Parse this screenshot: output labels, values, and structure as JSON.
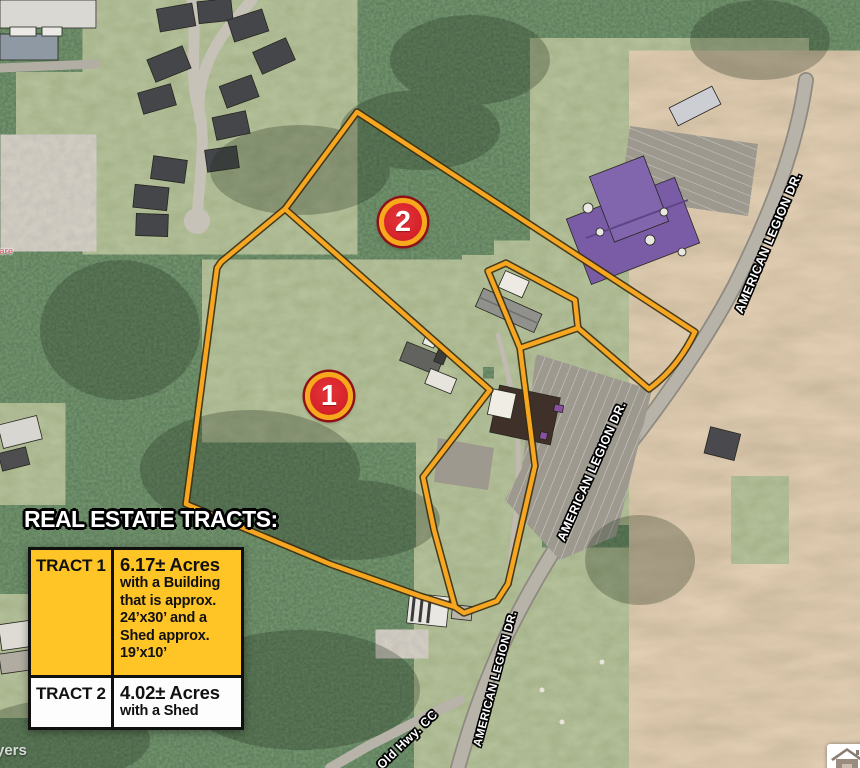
{
  "tracts_panel": {
    "header": "REAL ESTATE TRACTS:",
    "rows": [
      {
        "name": "TRACT 1",
        "desc": [
          "6.17± Acres",
          "with a Building",
          "that is approx.",
          "24’x30’ and a",
          "Shed approx.",
          "19’x10’"
        ]
      },
      {
        "name": "TRACT 2",
        "desc": [
          "4.02± Acres",
          "with a Shed"
        ]
      }
    ]
  },
  "markers": [
    {
      "number": "2"
    },
    {
      "number": "1"
    }
  ],
  "road_labels": [
    {
      "text": "AMERICAN LEGION DR."
    },
    {
      "text": "AMERICAN LEGION DR."
    },
    {
      "text": "AMERICAN LEGION DR."
    },
    {
      "text": "Old Hwy. CC"
    }
  ],
  "map_labels": [
    {
      "text": "Care"
    },
    {
      "text": "yers"
    }
  ],
  "colors": {
    "boundary_line": "#F7A622",
    "marker_red": "#D8242B",
    "marker_ring": "#F7A81B",
    "table_yellow": "#FFC425"
  }
}
